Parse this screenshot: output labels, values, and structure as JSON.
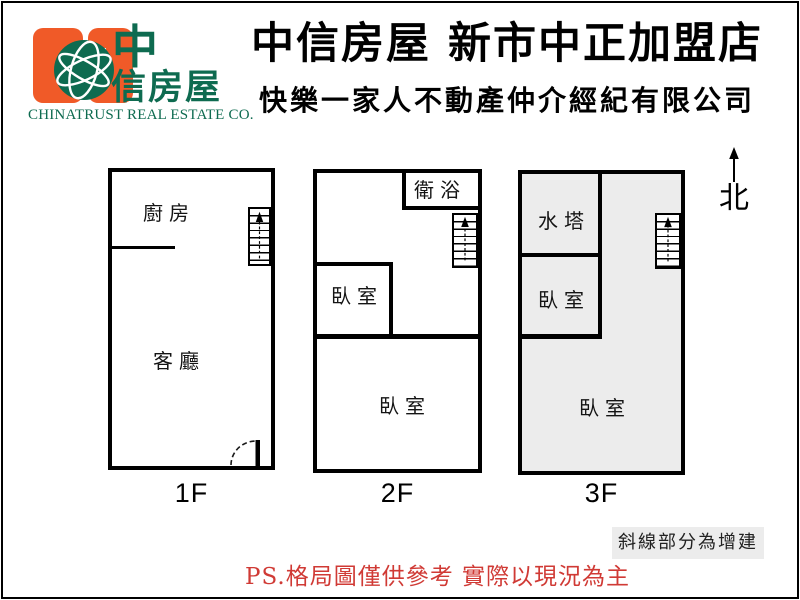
{
  "header": {
    "logo": {
      "brand_line1": "中",
      "brand_line2": "信房屋",
      "brand_en": "CHINATRUST REAL ESTATE CO."
    },
    "title": "中信房屋 新市中正加盟店",
    "subtitle": "快樂一家人不動產仲介經紀有限公司"
  },
  "floors": [
    {
      "caption": "1F",
      "rooms": {
        "kitchen": "廚房",
        "living_room": "客廳"
      }
    },
    {
      "caption": "2F",
      "rooms": {
        "bathroom": "衛浴",
        "bedroom_small": "臥室",
        "bedroom_main": "臥室"
      }
    },
    {
      "caption": "3F",
      "rooms": {
        "water_tank": "水塔",
        "bedroom_small": "臥室",
        "bedroom_main": "臥室"
      }
    }
  ],
  "compass": {
    "label": "北"
  },
  "legend_note": "斜線部分為增建",
  "footer_disclaimer": "PS.格局圖僅供參考 實際以現況為主",
  "colors": {
    "brand-orange": "#f05a28",
    "brand-green": "#0e6b50",
    "disclaimer-red": "#d03a35",
    "addition-gray": "#ececec"
  }
}
